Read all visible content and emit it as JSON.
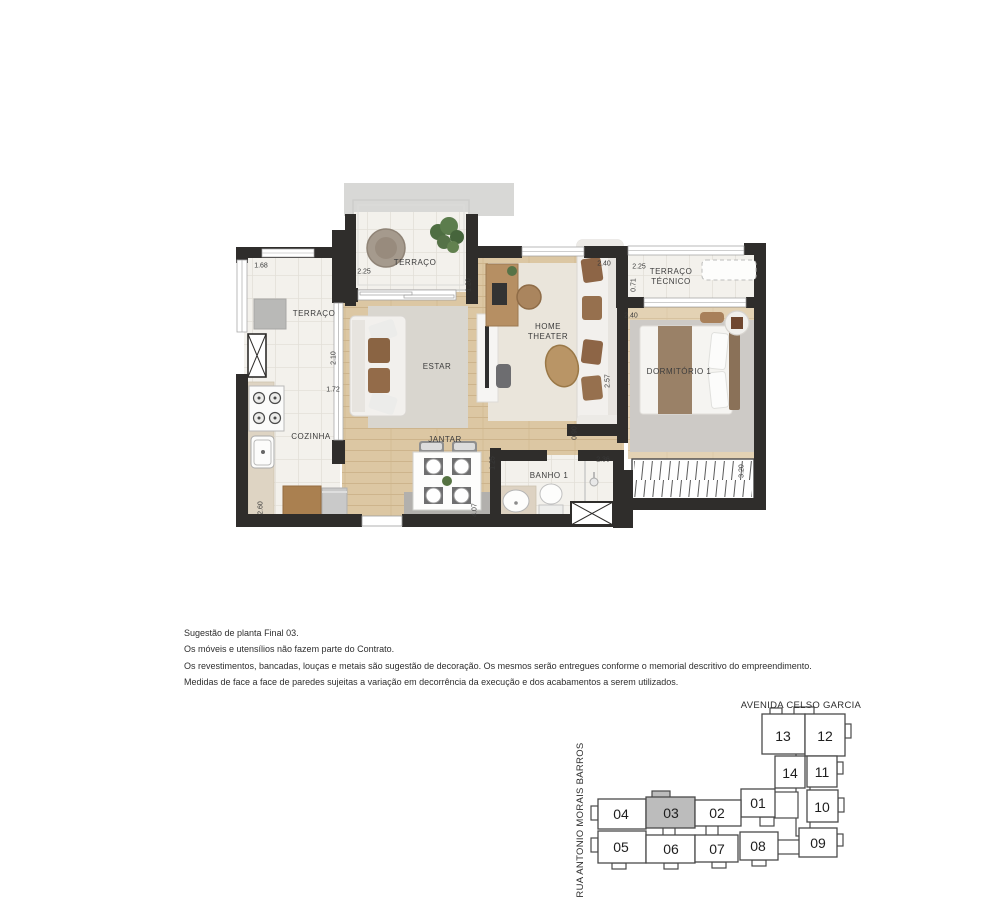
{
  "floorplan": {
    "rooms": [
      {
        "id": "terraco-left",
        "label": "TERRAÇO"
      },
      {
        "id": "terraco-top",
        "label": "TERRAÇO"
      },
      {
        "id": "estar",
        "label": "ESTAR"
      },
      {
        "id": "home-theater",
        "label": "HOME THEATER"
      },
      {
        "id": "terraco-tecnico",
        "label": "TERRAÇO TÉCNICO"
      },
      {
        "id": "dormitorio-1",
        "label": "DORMITÓRIO 1"
      },
      {
        "id": "cozinha",
        "label": "COZINHA"
      },
      {
        "id": "jantar",
        "label": "JANTAR"
      },
      {
        "id": "banho-1",
        "label": "BANHO 1"
      }
    ],
    "dimensions": [
      {
        "value": "1.68"
      },
      {
        "value": "2.25"
      },
      {
        "value": "1.20"
      },
      {
        "value": "2.40"
      },
      {
        "value": "2.25"
      },
      {
        "value": "0.71"
      },
      {
        "value": "2.40"
      },
      {
        "value": "2.10"
      },
      {
        "value": "1.72"
      },
      {
        "value": "2.57"
      },
      {
        "value": "0.90"
      },
      {
        "value": "1.25"
      },
      {
        "value": "2.36"
      },
      {
        "value": "2.60"
      },
      {
        "value": "4.07"
      },
      {
        "value": "3.20"
      }
    ]
  },
  "disclaimer": {
    "lines": [
      "Sugestão de planta Final 03.",
      "Os móveis e utensílios não fazem parte do Contrato.",
      "Os revestimentos, bancadas, louças e metais são sugestão de decoração. Os mesmos serão entregues conforme o memorial descritivo do empreendimento.",
      "Medidas de face a face de paredes sujeitas a variação em decorrência da execução e dos acabamentos a serem utilizados."
    ]
  },
  "keyplan": {
    "street_top": "AVENIDA CELSO GARCIA",
    "street_left": "RUA ANTONIO MORAIS BARROS",
    "highlighted_unit": "03",
    "units": [
      {
        "number": "01"
      },
      {
        "number": "02"
      },
      {
        "number": "03"
      },
      {
        "number": "04"
      },
      {
        "number": "05"
      },
      {
        "number": "06"
      },
      {
        "number": "07"
      },
      {
        "number": "08"
      },
      {
        "number": "09"
      },
      {
        "number": "10"
      },
      {
        "number": "11"
      },
      {
        "number": "12"
      },
      {
        "number": "13"
      },
      {
        "number": "14"
      }
    ]
  },
  "colors": {
    "wall": "#2f2d2b",
    "wood_floor": "#dcc7a3",
    "tile_floor": "#f3f1ec",
    "keyplan_highlight": "#bcbcbc"
  }
}
